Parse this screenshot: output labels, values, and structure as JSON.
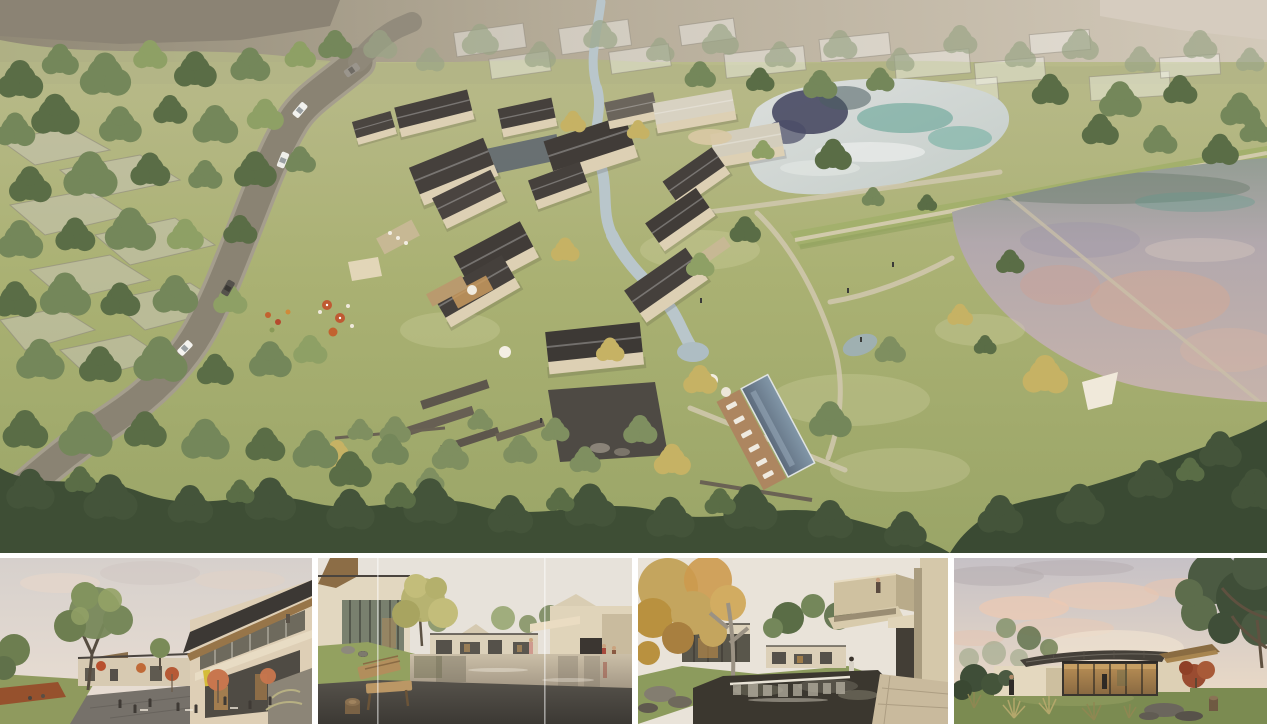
{
  "board": {
    "title": "architectural rendering presentation board",
    "background": "#ffffff",
    "panels": {
      "aerial": {
        "name": "aerial-masterplan-view",
        "description": "Bird's-eye rendering of a village resort: clusters of gabled guesthouses with dark roofs and cream walls along a winding stream, swimming pool with timber deck, cafe terrace and playground, a curving access road through woodland on the left, lawns with footpaths, an upper pond with teal tree reflections and a lower pink-tinted pond separated by a grass dam, dense tree canopy along the bottom, ghosted context buildings and fields at the horizon"
      },
      "plaza": {
        "name": "plaza-cafe-view",
        "description": "Eye-level view of a retail lane: two-storey building with sloping timber-soffit roof and glazed shopfront with a small yellow sign, orange cafe umbrellas, outdoor tables with guests, large green tree, corten planter with playing children, soft pink evening sky"
      },
      "water_court": {
        "name": "water-courtyard-view",
        "description": "Courtyard with a shallow reflecting pond between cream villas, tall glazed wall on the left, grassy knoll with rocks, wooden lounge bench and log stool on a dark deck in the foreground, figures in red by a shaded passage on the right"
      },
      "pond_terrace": {
        "name": "pond-terrace-view",
        "description": "Garden court with a dark koi pond and stone weir waterfall in the foreground, cantilevered concrete balcony with a standing figure on the upper right, glazed pavilions with warm interiors, golden autumn tree on the left, stone paving lower right"
      },
      "pavilion": {
        "name": "garden-pavilion-view",
        "description": "Single-storey pavilion with a dark standing-seam roof and timber wing, fully glazed warm-lit front, red maple beside it, mature dark tree framing the right edge, ornamental grasses and rocks in the foreground under a dusk sky with pink-lit clouds"
      }
    },
    "palette": {
      "lawn": "#a7ad74",
      "tree_green": "#74875a",
      "canopy_dark": "#3e4e35",
      "road_gray": "#8a8373",
      "roof_dark": "#45403c",
      "wall_cream": "#ddd0b4",
      "upper_pond": "#ced4d1",
      "upper_pond_reflection_navy": "#3f415c",
      "upper_pond_reflection_teal": "#4f9a8a",
      "lower_pond_mauve": "#b3a8ad",
      "lower_pond_pink": "#d8a893",
      "pool_blue": "#6d7f92",
      "deck_wood": "#ad8660",
      "umbrella_orange": "#bf5a33",
      "autumn_yellow": "#c6b264",
      "dusk_sky": "#e9d9c6",
      "cloud_pink": "#ecc9b2"
    }
  }
}
